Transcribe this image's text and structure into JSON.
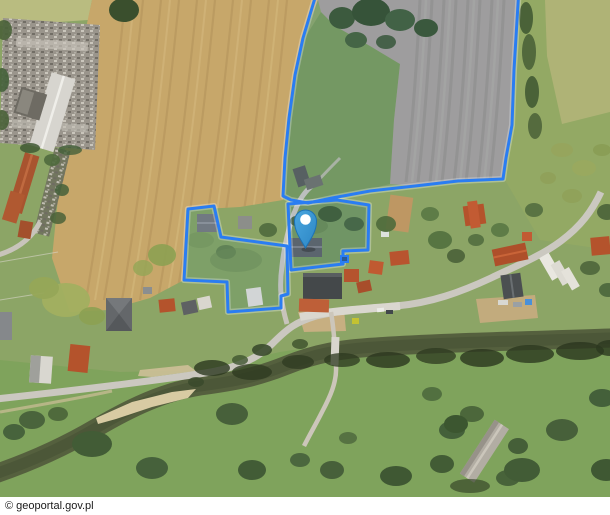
{
  "footer": {
    "attribution": "© geoportal.gov.pl"
  },
  "map": {
    "background_color": "#8CA566",
    "parcel_style": {
      "stroke": "#2A7DF2",
      "halo": "rgba(255,255,255,0.30)",
      "fill": "rgba(42,125,242,0.07)",
      "annex_fill": "#2B5A94"
    },
    "marker": {
      "x": 305.5,
      "tip_y": 248,
      "fill_top": "#4AA6DF",
      "fill_bottom": "#2C86C4",
      "stroke": "#1D72B5",
      "dot_color": "#FFFFFF"
    },
    "parcels": {
      "north_field": {
        "points": [
          [
            318,
            -12
          ],
          [
            303,
            38
          ],
          [
            295,
            75
          ],
          [
            289,
            118
          ],
          [
            285,
            158
          ],
          [
            283,
            196
          ],
          [
            291,
            200
          ],
          [
            308,
            203
          ],
          [
            332,
            198
          ],
          [
            370,
            191
          ],
          [
            415,
            186
          ],
          [
            458,
            181
          ],
          [
            503,
            179
          ],
          [
            506,
            158
          ],
          [
            512,
            125
          ],
          [
            514,
            70
          ],
          [
            519,
            -12
          ]
        ]
      },
      "west_meadow": {
        "points": [
          [
            188,
            209
          ],
          [
            214,
            206
          ],
          [
            221,
            237
          ],
          [
            287,
            246
          ],
          [
            288,
            294
          ],
          [
            281,
            296
          ],
          [
            281,
            308
          ],
          [
            228,
            312
          ],
          [
            227,
            282
          ],
          [
            184,
            280
          ]
        ]
      },
      "homestead": {
        "points": [
          [
            288,
            204
          ],
          [
            337,
            200
          ],
          [
            369,
            205
          ],
          [
            368,
            250
          ],
          [
            343,
            251
          ],
          [
            343,
            264
          ],
          [
            291,
            270
          ]
        ]
      },
      "small_annex": {
        "points": [
          [
            341,
            256
          ],
          [
            348,
            256
          ],
          [
            348,
            262
          ],
          [
            341,
            262
          ]
        ]
      }
    }
  }
}
